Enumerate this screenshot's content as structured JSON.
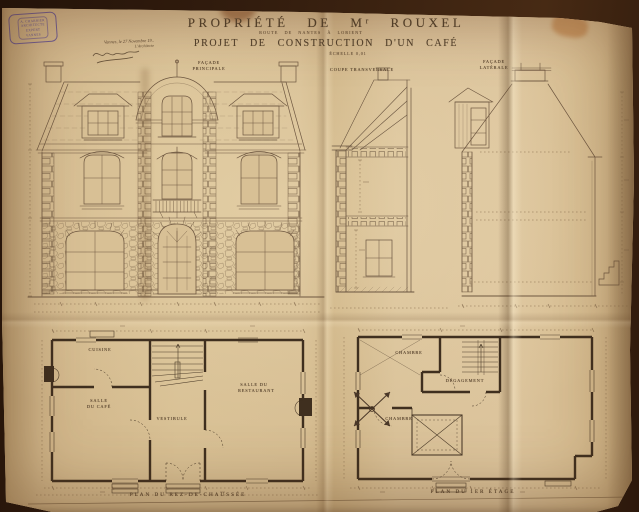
{
  "photo": {
    "paper_color": "#d6bd92",
    "background_color": "#2e190c",
    "ink_color": "#5e4a34",
    "stamp_color": "#4c3e96"
  },
  "stamp": {
    "lines": [
      "A. CHARRIER",
      "Architecte",
      "Expert",
      "Vannes"
    ]
  },
  "annotation": {
    "dateline": "Vannes, le 27 Novembre 19..",
    "signer": "L'Architecte"
  },
  "title": {
    "line1": "Propriété de Mʳ Rouxel",
    "route": "Route de Nantes à Lorient",
    "line2": "Projet de Construction d'un Café",
    "scale": "Échelle 0,01"
  },
  "labels": {
    "front_elevation": "Façade principale",
    "cross_section": "Coupe transversale",
    "side_elevation": "Façade latérale"
  },
  "ground_floor": {
    "caption": "Plan du Rez-de-Chaussée",
    "rooms": {
      "kitchen": "Cuisine",
      "cafe": "Salle du Café",
      "hall": "Vestibule",
      "restaurant": "Salle du Restaurant"
    }
  },
  "first_floor": {
    "caption": "Plan du 1er Étage",
    "rooms": {
      "bedroom1": "Chambre",
      "landing": "Dégagement",
      "bedroom2": "Chambre"
    }
  }
}
